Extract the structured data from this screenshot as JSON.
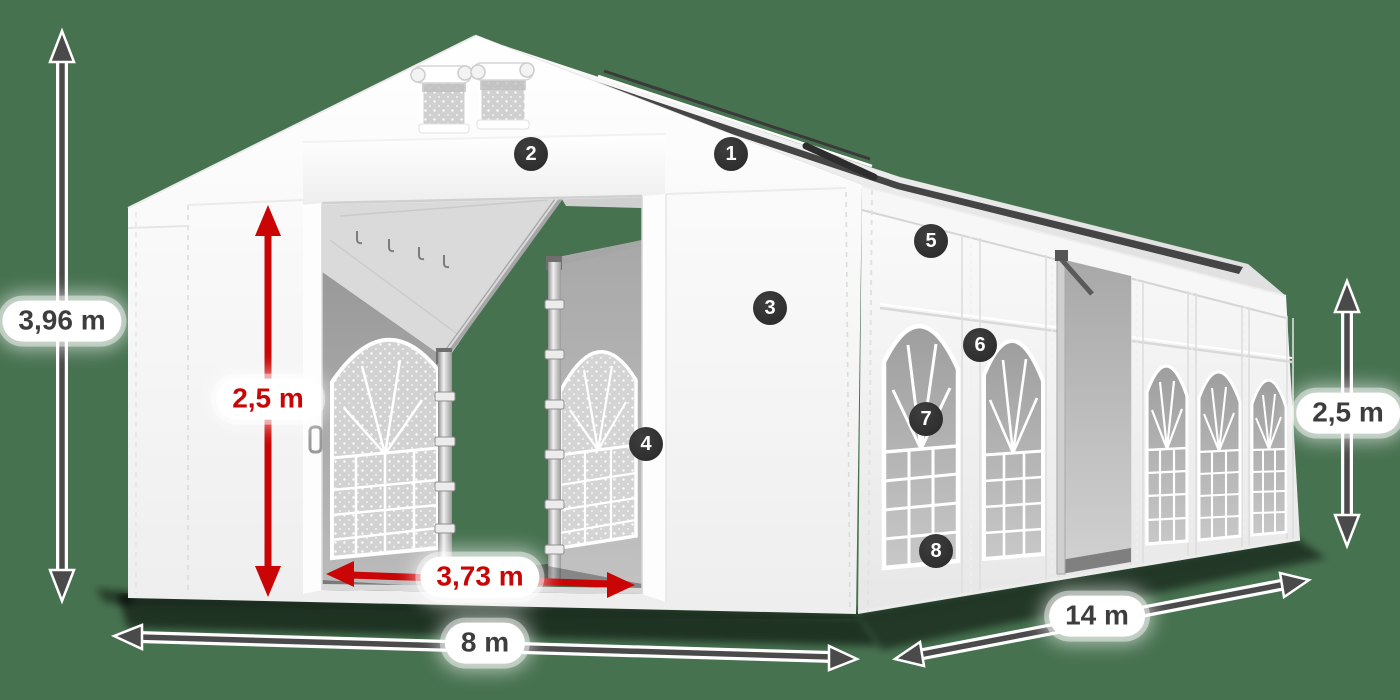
{
  "diagram": {
    "subject": "tent-dimension-diagram",
    "view": "white marquee tent, front-left perspective, gable roof, open front door, side wall with arched windows"
  },
  "dimensions": {
    "total_height": {
      "label": "3,96 m",
      "style": "dark",
      "orientation": "vertical-left"
    },
    "door_height": {
      "label": "2,5 m",
      "style": "red",
      "orientation": "vertical-door"
    },
    "door_width": {
      "label": "3,73 m",
      "style": "red",
      "orientation": "horizontal-door"
    },
    "width": {
      "label": "8 m",
      "style": "dark",
      "orientation": "horizontal-front"
    },
    "length": {
      "label": "14 m",
      "style": "dark",
      "orientation": "diagonal-side"
    },
    "side_height": {
      "label": "2,5 m",
      "style": "dark",
      "orientation": "vertical-right"
    }
  },
  "callouts": [
    {
      "label": "1"
    },
    {
      "label": "2"
    },
    {
      "label": "3"
    },
    {
      "label": "4"
    },
    {
      "label": "5"
    },
    {
      "label": "6"
    },
    {
      "label": "7"
    },
    {
      "label": "8"
    }
  ],
  "colors": {
    "background": "#477250",
    "dimension_red": "#c90505",
    "dimension_dark": "#4a4a4a",
    "badge_background": "#2e2e2e",
    "badge_text": "#ffffff",
    "label_text": "#3d3d3d",
    "tent_fabric": "#ffffff"
  }
}
